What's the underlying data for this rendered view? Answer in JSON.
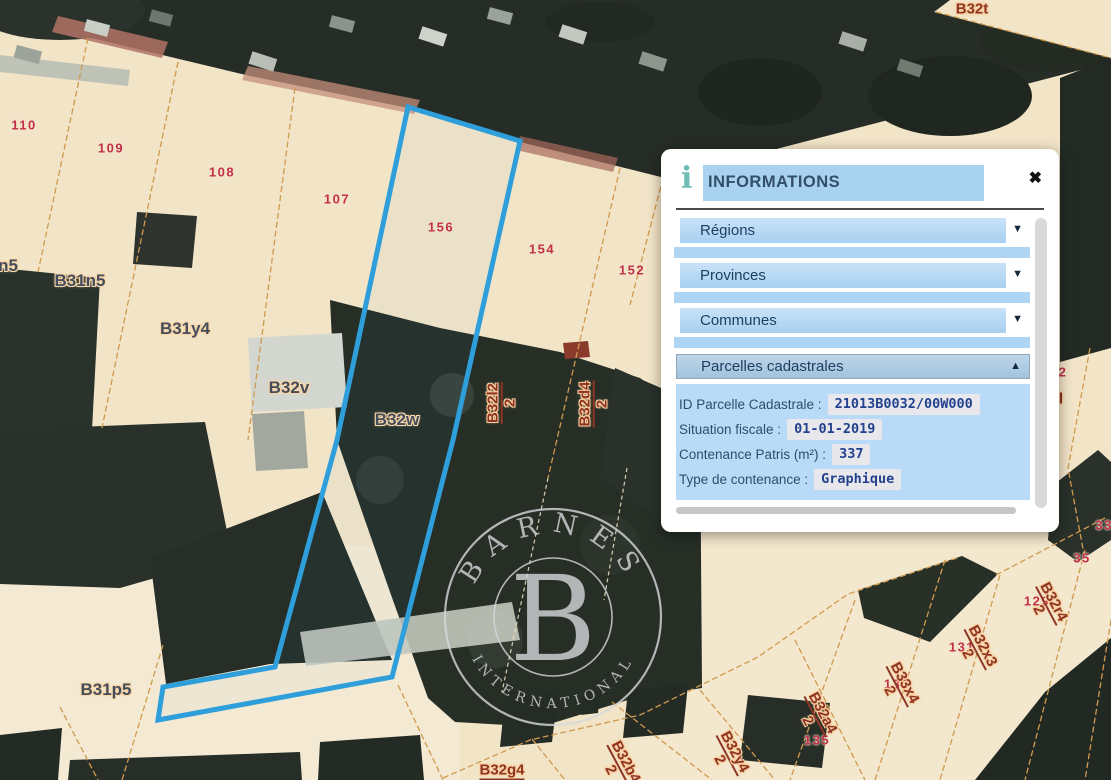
{
  "panel": {
    "title": "INFORMATIONS",
    "dropdowns": [
      {
        "label": "Régions"
      },
      {
        "label": "Provinces"
      },
      {
        "label": "Communes"
      }
    ],
    "section_label": "Parcelles cadastrales",
    "fields": [
      {
        "label": "ID Parcelle Cadastrale :",
        "value": "21013B0032/00W000"
      },
      {
        "label": "Situation fiscale :",
        "value": "01-01-2019"
      },
      {
        "label": "Contenance Patris (m²) :",
        "value": "337"
      },
      {
        "label": "Type de contenance :",
        "value": "Graphique"
      }
    ]
  },
  "icons": {
    "info": "i",
    "close": "✖",
    "caret_down": "▼",
    "caret_up": "▲"
  },
  "map": {
    "watermark": {
      "arc_top": "BARNES",
      "monogram": "B",
      "arc_bottom": "INTERNATIONAL"
    },
    "parcel_numbers": [
      {
        "t": "110",
        "x": 24,
        "y": 125
      },
      {
        "t": "109",
        "x": 111,
        "y": 148
      },
      {
        "t": "108",
        "x": 222,
        "y": 172
      },
      {
        "t": "107",
        "x": 337,
        "y": 199
      },
      {
        "t": "156",
        "x": 441,
        "y": 227
      },
      {
        "t": "154",
        "x": 542,
        "y": 249
      },
      {
        "t": "152",
        "x": 632,
        "y": 270
      },
      {
        "t": "2",
        "x": 1063,
        "y": 372
      },
      {
        "t": "33",
        "x": 1104,
        "y": 525
      },
      {
        "t": "35",
        "x": 1082,
        "y": 558
      },
      {
        "t": "129",
        "x": 1037,
        "y": 601
      },
      {
        "t": "131",
        "x": 962,
        "y": 647
      },
      {
        "t": "133",
        "x": 897,
        "y": 684
      },
      {
        "t": "135",
        "x": 817,
        "y": 740
      }
    ],
    "parcel_letter_labels": [
      {
        "t": "n5",
        "x": 8,
        "y": 266
      },
      {
        "t": "B31n5",
        "x": 80,
        "y": 281
      },
      {
        "t": "B31y4",
        "x": 185,
        "y": 329
      },
      {
        "t": "B32v",
        "x": 289,
        "y": 388
      },
      {
        "t": "B32w",
        "x": 397,
        "y": 420
      },
      {
        "t": "B31p5",
        "x": 106,
        "y": 690
      },
      {
        "t": "B32t",
        "x": 972,
        "y": 9,
        "maroon": true
      },
      {
        "t": "l",
        "x": 1061,
        "y": 399,
        "maroon": true
      },
      {
        "t": "B32g4",
        "x": 502,
        "y": 771,
        "maroon": true,
        "underline": true
      }
    ],
    "fraction_labels": [
      {
        "num": "B32l2",
        "den": "2",
        "x": 502,
        "y": 403,
        "rot": -90
      },
      {
        "num": "B32d4",
        "den": "2",
        "x": 594,
        "y": 404,
        "rot": -90
      },
      {
        "num": "B32r4",
        "den": "2",
        "x": 1046,
        "y": 606,
        "rot": 62
      },
      {
        "num": "B32x3",
        "den": "2",
        "x": 975,
        "y": 650,
        "rot": 62
      },
      {
        "num": "B33x4",
        "den": "2",
        "x": 897,
        "y": 687,
        "rot": 62
      },
      {
        "num": "B32a4",
        "den": "2",
        "x": 815,
        "y": 717,
        "rot": 62
      },
      {
        "num": "B32y4",
        "den": "2",
        "x": 727,
        "y": 756,
        "rot": 62
      },
      {
        "num": "B32b4",
        "den": "2",
        "x": 618,
        "y": 766,
        "rot": 62
      }
    ],
    "colors": {
      "parcel_fill": "#f2e4c7",
      "boundary_line": "#cf9a4e",
      "highlight_outline": "#2f9fdb",
      "parcel_number": "#c22f48",
      "letter_label": "#454c5c",
      "fraction_label": "#8e3424",
      "panel_band": "#a9d2f1",
      "panel_detail_bg": "#b9dbf7",
      "value_ink": "#22418f"
    }
  }
}
